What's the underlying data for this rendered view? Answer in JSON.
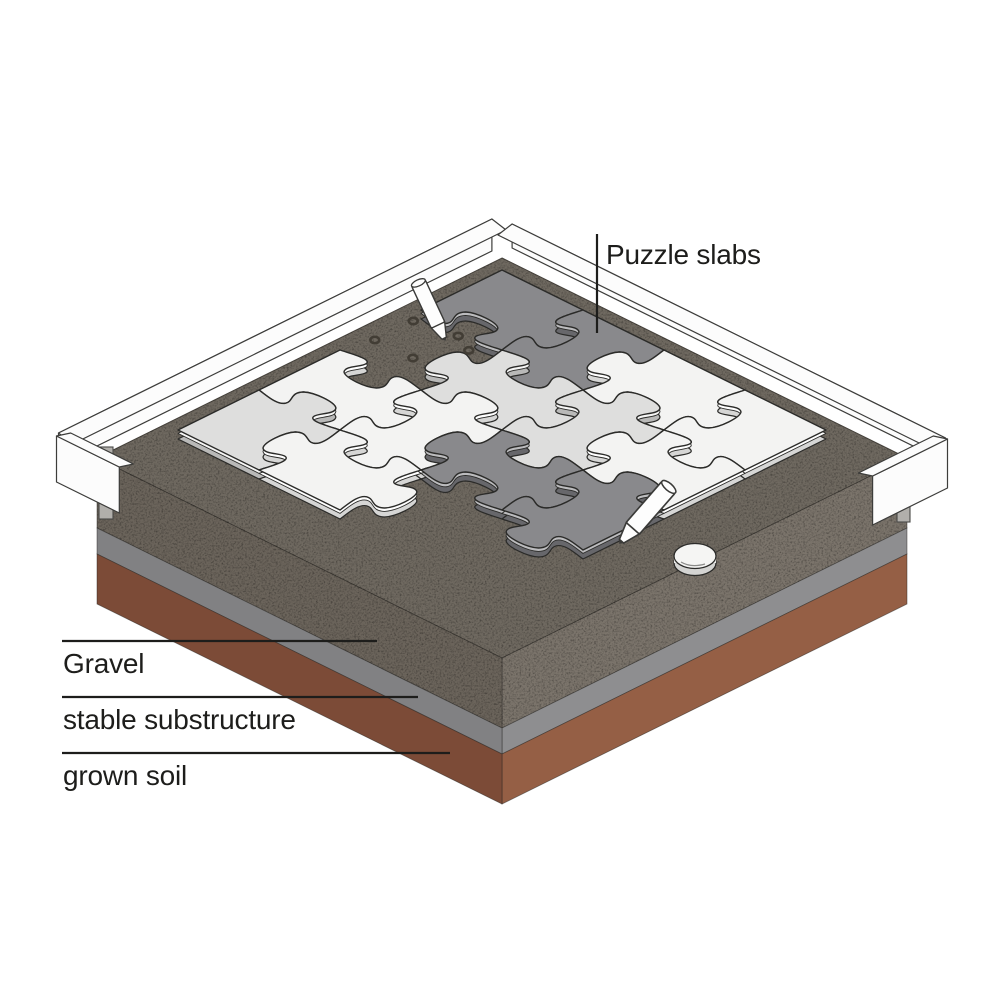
{
  "figure": {
    "title": "Puzzle slab pavement build-up (isometric diagram)"
  },
  "labels": {
    "puzzle_slabs": "Puzzle slabs",
    "gravel": "Gravel",
    "substructure": "stable substructure",
    "soil": "grown soil"
  },
  "scene": {
    "background": "#ffffff",
    "text_color": "#1d1d1b",
    "leader_color": "#1d1d1b",
    "outline": "#2b2b29",
    "proj": {
      "cx": 502,
      "cy": 258,
      "ax": 405,
      "ay": 200
    },
    "bed": {
      "top": "#6f6960",
      "edge_stroke": "#46423c",
      "layers": [
        {
          "name": "gravel",
          "h": 70,
          "left": "#6b645b",
          "right": "#7b746b"
        },
        {
          "name": "substructure",
          "h": 26,
          "left": "#818183",
          "right": "#8e8e90"
        },
        {
          "name": "soil",
          "h": 50,
          "left": "#7c4b37",
          "right": "#955f45"
        }
      ]
    },
    "slab_palette": {
      "D": {
        "top": "#89898c",
        "bevel": "#bcbcbe",
        "side": "#67676b"
      },
      "L": {
        "top": "#dededd",
        "bevel": "#f6f6f5",
        "side": "#b9b9b8"
      },
      "W": {
        "top": "#f3f3f2",
        "bevel": "#ffffff",
        "side": "#d6d6d5"
      }
    },
    "grid": {
      "field_origin": 0.03,
      "cell": 0.2,
      "thickness": 9,
      "bevel": 3.4,
      "rows": [
        [
          "D",
          "D",
          "W",
          "W"
        ],
        [
          "",
          "L",
          "L",
          "W"
        ],
        [
          "W",
          "W",
          "D",
          "D"
        ],
        [
          "L",
          "W",
          "",
          ""
        ]
      ]
    },
    "rail": {
      "fill": "#fcfcfc",
      "stroke": "#3d3d3b"
    },
    "stake_fill": "#b1afab",
    "stakes": [
      {
        "x": 99,
        "y": 447,
        "w": 14,
        "h": 72
      },
      {
        "x": 897,
        "y": 466,
        "w": 13,
        "h": 56
      }
    ],
    "dots": {
      "stroke": "#423d35",
      "items": [
        [
          0.048,
          0.267
        ],
        [
          0.048,
          0.362
        ],
        [
          0.14,
          0.36
        ],
        [
          0.141,
          0.249
        ],
        [
          0.19,
          0.272
        ]
      ]
    },
    "pen_fill": "#fdfdfd",
    "pens": [
      {
        "x": 445,
        "y": 340,
        "angle": -25,
        "scale": 1.0
      },
      {
        "x": 620,
        "y": 543,
        "angle": 41,
        "scale": 1.18
      }
    ],
    "scrap": {
      "x": 695,
      "y": 556
    },
    "leaders": {
      "puzzle": {
        "x": 597,
        "y1": 234,
        "y2": 333
      },
      "gravel": {
        "y": 641,
        "x1": 62,
        "x2": 377
      },
      "substructure": {
        "y": 697,
        "x1": 62,
        "x2": 418
      },
      "soil": {
        "y": 753,
        "x1": 62,
        "x2": 450
      }
    }
  }
}
